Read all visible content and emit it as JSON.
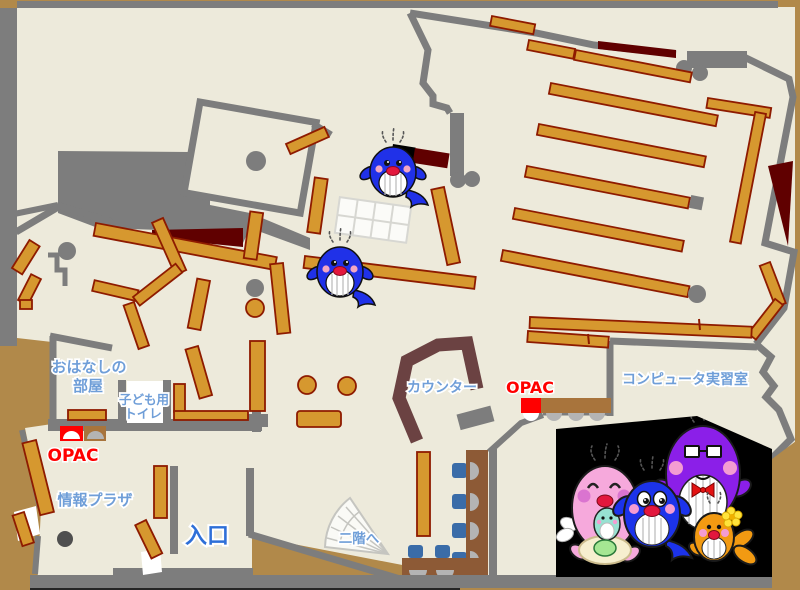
{
  "region_labels": {
    "story_room_line1": "おはなしの",
    "story_room_line2": "部屋",
    "kids_toilet_line1": "子ども用",
    "kids_toilet_line2": "トイレ",
    "opac_info_plaza": "OPAC",
    "opac_counter": "OPAC",
    "info_plaza": "情報プラザ",
    "entrance": "入口",
    "to_second_floor": "二階へ",
    "counter": "カウンター",
    "computer_room": "コンピュータ実習室"
  },
  "icons": {
    "map_mascot": "blue-whale-mascot",
    "photo_characters": "whale-family-mascots (pink, purple, blue, orange)"
  },
  "colors": {
    "frame": "#b1894a",
    "floor": "#edeadb",
    "wall": "#7d7d7d",
    "shelf": "#d6982f",
    "shelf_border": "#8e1b00",
    "dark_red": "#600000",
    "counter": "#6b4242",
    "desk": "#8d5a36",
    "desk_light": "#a8743c",
    "chair_blue": "#3a6ca8",
    "seat_gray": "#b4b4b4",
    "opac_red": "#ff0000",
    "label_blue": "#6f9ed8",
    "entrance_blue": "#2e6fd8",
    "photo_bg": "#000000",
    "mascot_pink": "#f6a9dc",
    "mascot_purple": "#8b1fe8",
    "mascot_blue": "#1c33ea",
    "mascot_orange": "#f29a12",
    "whale_blue": "#2031e8"
  }
}
